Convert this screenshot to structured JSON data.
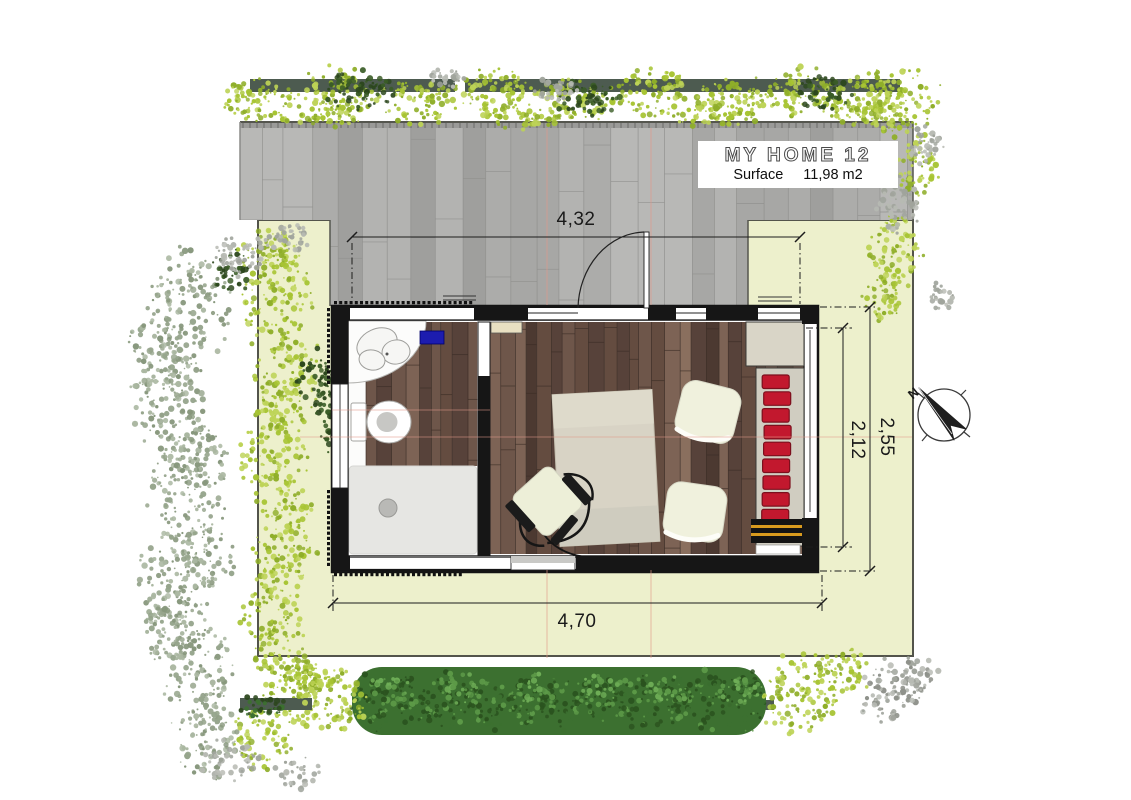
{
  "title_block": {
    "title": "MY HOME 12",
    "surface_label": "Surface",
    "surface_value": "11,98 m2"
  },
  "dimensions": {
    "top_width": "4,32",
    "bottom_width": "4,70",
    "right_outer_height": "2,55",
    "right_inner_height": "2,12"
  },
  "compass": {
    "north_label": "N"
  },
  "colors": {
    "lawn": "#edf0cc",
    "lawn_border": "#53544b",
    "deck_base": "#ababa9",
    "deck_sep": "#8f8f8d",
    "deck_edge": "#5e5e5c",
    "deck_palette": [
      "#b3b3b1",
      "#a7a7a5",
      "#9f9f9d",
      "#acacaa",
      "#b8b8b6"
    ],
    "hedge_bar": "#4d5b50",
    "foliage_yellow": "#a7c433",
    "foliage_yellow_dark": "#8fae29",
    "foliage_yellow_light": "#bdd356",
    "foliage_dark": "#2c471d",
    "foliage_sage": "#96a58c",
    "foliage_sage_light": "#aab7a1",
    "foliage_gray": "#a0a49c",
    "foliage_gray_light": "#b7bab3",
    "hedge_green": "#3c7030",
    "hedge_green_dark": "#2b531f",
    "hedge_green_light": "#5d9a48",
    "wall": "#161616",
    "wood_palette": [
      "#57423a",
      "#6e564a",
      "#7d6355",
      "#4c3931",
      "#8a6f5e",
      "#644c40"
    ],
    "wood_sep": "#3a2c25",
    "shower": "#e6e6e3",
    "drain": "#b9b9b6",
    "mat_blue": "#1c1caf",
    "table": "#d8d3c5",
    "pouf": "#f0f1dd",
    "sofa_red": "#c2182e",
    "sofa_red_dark": "#7c0f1d",
    "sofa_base": "#d0cdc1",
    "counter": "#d9d5c7",
    "bench_black": "#141414",
    "bench_stripe": "#d99b1e",
    "chair_seat": "#edefd8",
    "dim_line": "#1c1c1c",
    "ref_line": "#e2998a"
  }
}
